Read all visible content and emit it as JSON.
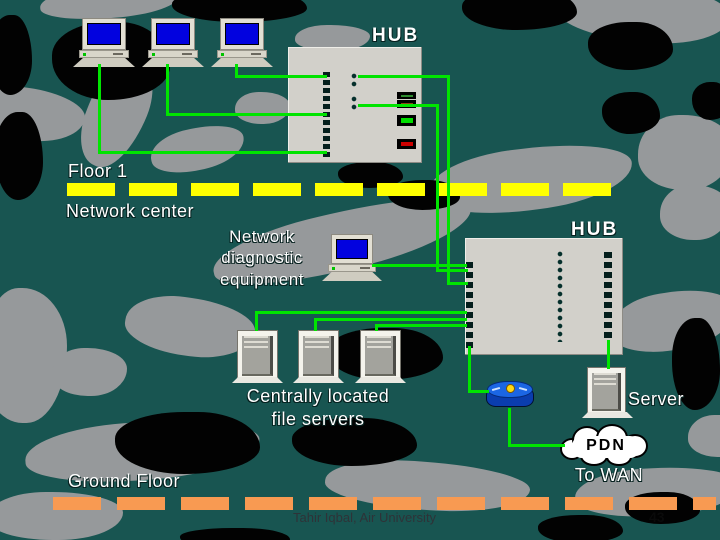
{
  "slide": {
    "footer": "Tahir Iqbal, Air University",
    "page_number": "43"
  },
  "labels": {
    "hub_top": "HUB",
    "hub_right": "HUB",
    "floor1": "Floor 1",
    "network_center": "Network center",
    "diagnostic_equipment": [
      "Network",
      "diagnostic",
      "equipment"
    ],
    "file_servers": [
      "Centrally located",
      "file servers"
    ],
    "server": "Server",
    "pdn": "PDN",
    "to_wan": "To WAN",
    "ground_floor": "Ground Floor"
  },
  "diagram": {
    "devices": [
      {
        "id": "workstation-1",
        "type": "workstation-icon"
      },
      {
        "id": "workstation-2",
        "type": "workstation-icon"
      },
      {
        "id": "workstation-3",
        "type": "workstation-icon"
      },
      {
        "id": "hub-top",
        "type": "hub-device-icon",
        "label": "HUB"
      },
      {
        "id": "diagnostic-workstation",
        "type": "workstation-icon",
        "label": "Network diagnostic equipment"
      },
      {
        "id": "hub-right",
        "type": "hub-device-icon",
        "label": "HUB"
      },
      {
        "id": "file-server-1",
        "type": "server-tower-icon"
      },
      {
        "id": "file-server-2",
        "type": "server-tower-icon"
      },
      {
        "id": "file-server-3",
        "type": "server-tower-icon"
      },
      {
        "id": "server",
        "type": "server-tower-icon",
        "label": "Server"
      },
      {
        "id": "router",
        "type": "router-icon"
      },
      {
        "id": "pdn-cloud",
        "type": "cloud-icon",
        "label": "PDN",
        "note": "To WAN"
      }
    ],
    "connections": [
      "workstation-1 -> hub-top",
      "workstation-2 -> hub-top",
      "workstation-3 -> hub-top",
      "hub-top -> hub-right (x2)",
      "diagnostic-workstation -> hub-right",
      "file-server-1 -> hub-right",
      "file-server-2 -> hub-right",
      "file-server-3 -> hub-right",
      "hub-right -> router",
      "router -> pdn-cloud",
      "hub-right -> server"
    ]
  },
  "colors": {
    "background_teal": "#185551",
    "camo_gray": "#96999b",
    "camo_black": "#020202",
    "cable_green": "#00e400",
    "floor_divider_yellow": "#ffff00",
    "floor_divider_orange": "#f89a52",
    "hub_gray": "#d2d0ca",
    "screen_blue": "#0202df",
    "router_blue": "#1b66e4",
    "led_green": "#00dd00",
    "led_red": "#cc0000"
  }
}
